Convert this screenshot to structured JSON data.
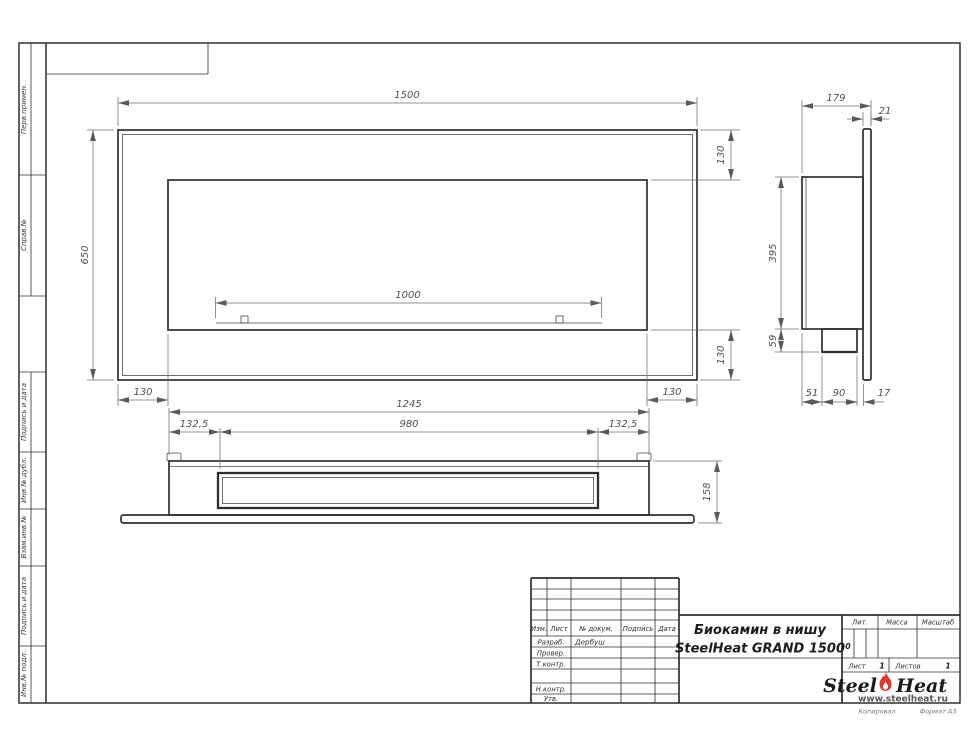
{
  "margin_labels": [
    "Перв.примен.",
    "Справ.№",
    "Подпись и дата",
    "Инв.№ дубл.",
    "Взам.инв.№",
    "Подпись и дата",
    "Инв.№ подл."
  ],
  "dimensions": {
    "front": {
      "overall_width": "1500",
      "overall_height": "650",
      "frame_top": "130",
      "frame_bottom": "130",
      "burner_length": "1000",
      "frame_left": "130",
      "frame_right": "130"
    },
    "plan": {
      "body_width": "1245",
      "side_left": "132,5",
      "insert_width": "980",
      "side_right": "132,5",
      "depth": "158"
    },
    "side": {
      "total_depth": "179",
      "panel_thickness": "21",
      "body_height": "395",
      "tray_height": "59",
      "tray_offset": "51",
      "tray_width": "90",
      "gap": "17"
    }
  },
  "title_block": {
    "header_cols": [
      "Изм.",
      "Лист",
      "№ докум.",
      "Подпись",
      "Дата"
    ],
    "approval_rows": [
      {
        "label": "Разраб.",
        "value": "Дербуш"
      },
      {
        "label": "Провер.",
        "value": ""
      },
      {
        "label": "Т.контр.",
        "value": ""
      },
      {
        "label": "Н.контр.",
        "value": ""
      },
      {
        "label": "Утв.",
        "value": ""
      }
    ],
    "title_line1": "Биокамин в нишу",
    "title_line2": "SteelHeat GRAND 1500",
    "lit_label": "Лит.",
    "lit_value": "0",
    "mass_label": "Масса",
    "scale_label": "Масштаб",
    "sheet_label": "Лист",
    "sheet_number": "1",
    "sheets_label": "Листов",
    "sheets_total": "1"
  },
  "logo": {
    "word1": "Steel",
    "word2": "Heat",
    "url": "www.steelheat.ru"
  },
  "footer": {
    "copied_by": "Копировал",
    "format": "Формат А3"
  },
  "colors": {
    "line": "#2f2f2f",
    "dim_text": "#4f4f4f",
    "flame_red": "#e5332a"
  }
}
